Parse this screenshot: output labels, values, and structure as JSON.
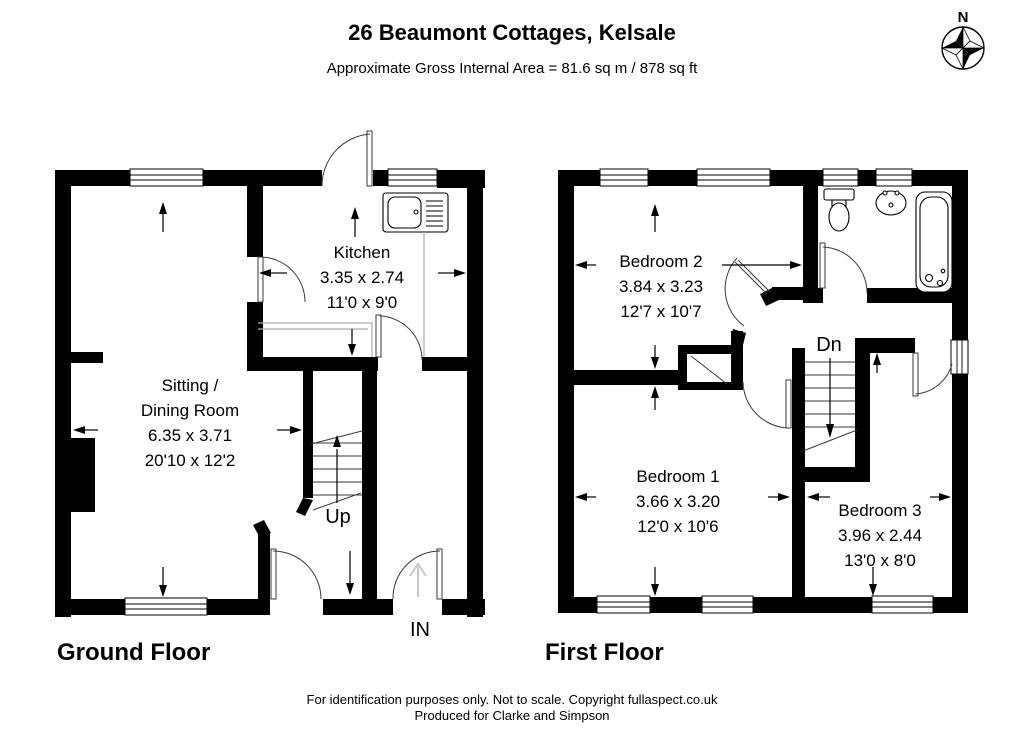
{
  "title": "26 Beaumont Cottages, Kelsale",
  "subtitle": "Approximate Gross Internal Area = 81.6 sq m / 878 sq ft",
  "compass": {
    "north_label": "N"
  },
  "footer": {
    "line1": "For identification purposes only. Not to scale. Copyright fullaspect.co.uk",
    "line2": "Produced for Clarke and Simpson"
  },
  "ground_floor": {
    "label": "Ground Floor",
    "entrance_label": "IN",
    "stairs_label": "Up",
    "rooms": {
      "kitchen": {
        "name": "Kitchen",
        "size_metric": "3.35 x 2.74",
        "size_imperial": "11'0 x 9'0"
      },
      "sitting_dining": {
        "name_line1": "Sitting /",
        "name_line2": "Dining Room",
        "size_metric": "6.35 x 3.71",
        "size_imperial": "20'10 x 12'2"
      }
    }
  },
  "first_floor": {
    "label": "First Floor",
    "stairs_label": "Dn",
    "rooms": {
      "bedroom1": {
        "name": "Bedroom 1",
        "size_metric": "3.66 x 3.20",
        "size_imperial": "12'0 x 10'6"
      },
      "bedroom2": {
        "name": "Bedroom 2",
        "size_metric": "3.84 x 3.23",
        "size_imperial": "12'7 x 10'7"
      },
      "bedroom3": {
        "name": "Bedroom 3",
        "size_metric": "3.96 x 2.44",
        "size_imperial": "13'0 x 8'0"
      }
    }
  },
  "colors": {
    "wall": "#000000",
    "line": "#3a3a3a",
    "counter_line": "#aaaaaa",
    "entrance_arrow": "#c8c8c8",
    "background": "#ffffff"
  }
}
